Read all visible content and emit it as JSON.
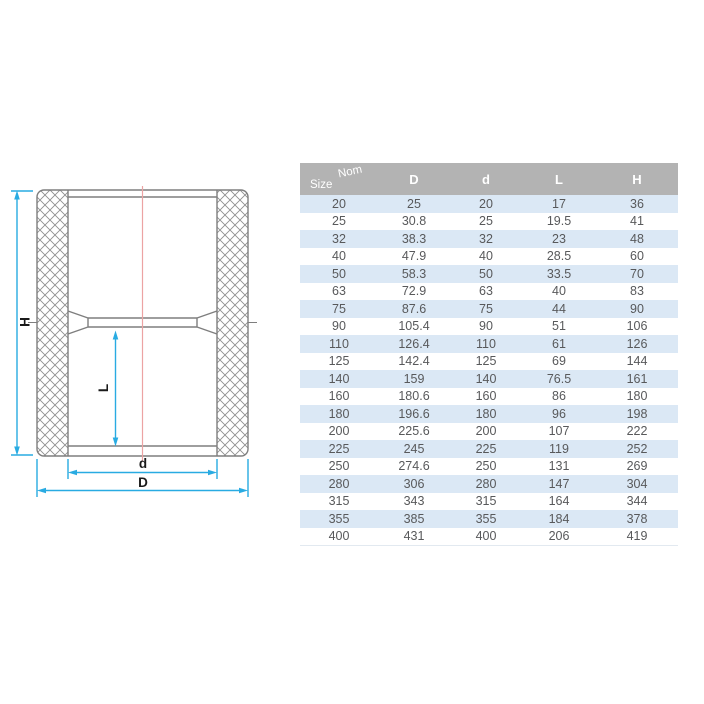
{
  "diagram": {
    "type": "pipe-coupling-cross-section",
    "labels": {
      "overall_length": "H",
      "socket_depth": "L",
      "inner_diameter": "d",
      "outer_diameter": "D"
    },
    "colors": {
      "dimension_line": "#29abe2",
      "centerline": "#eca3a3",
      "outline": "#7e7e7e",
      "label_text": "#1a1a1a"
    }
  },
  "table": {
    "corner": {
      "top": "Nom",
      "bottom": "Size"
    },
    "headers": [
      "D",
      "d",
      "L",
      "H"
    ],
    "rows": [
      [
        20,
        25,
        20,
        17,
        36
      ],
      [
        25,
        30.8,
        25,
        19.5,
        41
      ],
      [
        32,
        38.3,
        32,
        23,
        48
      ],
      [
        40,
        47.9,
        40,
        28.5,
        60
      ],
      [
        50,
        58.3,
        50,
        33.5,
        70
      ],
      [
        63,
        72.9,
        63,
        40,
        83
      ],
      [
        75,
        87.6,
        75,
        44,
        90
      ],
      [
        90,
        105.4,
        90,
        51,
        106
      ],
      [
        110,
        126.4,
        110,
        61,
        126
      ],
      [
        125,
        142.4,
        125,
        69,
        144
      ],
      [
        140,
        159,
        140,
        76.5,
        161
      ],
      [
        160,
        180.6,
        160,
        86,
        180
      ],
      [
        180,
        196.6,
        180,
        96,
        198
      ],
      [
        200,
        225.6,
        200,
        107,
        222
      ],
      [
        225,
        245,
        225,
        119,
        252
      ],
      [
        250,
        274.6,
        250,
        131,
        269
      ],
      [
        280,
        306,
        280,
        147,
        304
      ],
      [
        315,
        343,
        315,
        164,
        344
      ],
      [
        355,
        385,
        355,
        184,
        378
      ],
      [
        400,
        431,
        400,
        206,
        419
      ]
    ],
    "colors": {
      "header_bg": "#b3b3b3",
      "header_text": "#ffffff",
      "row_bg": "#ffffff",
      "row_alt_bg": "#dbe8f5",
      "cell_text": "#58595b"
    }
  }
}
